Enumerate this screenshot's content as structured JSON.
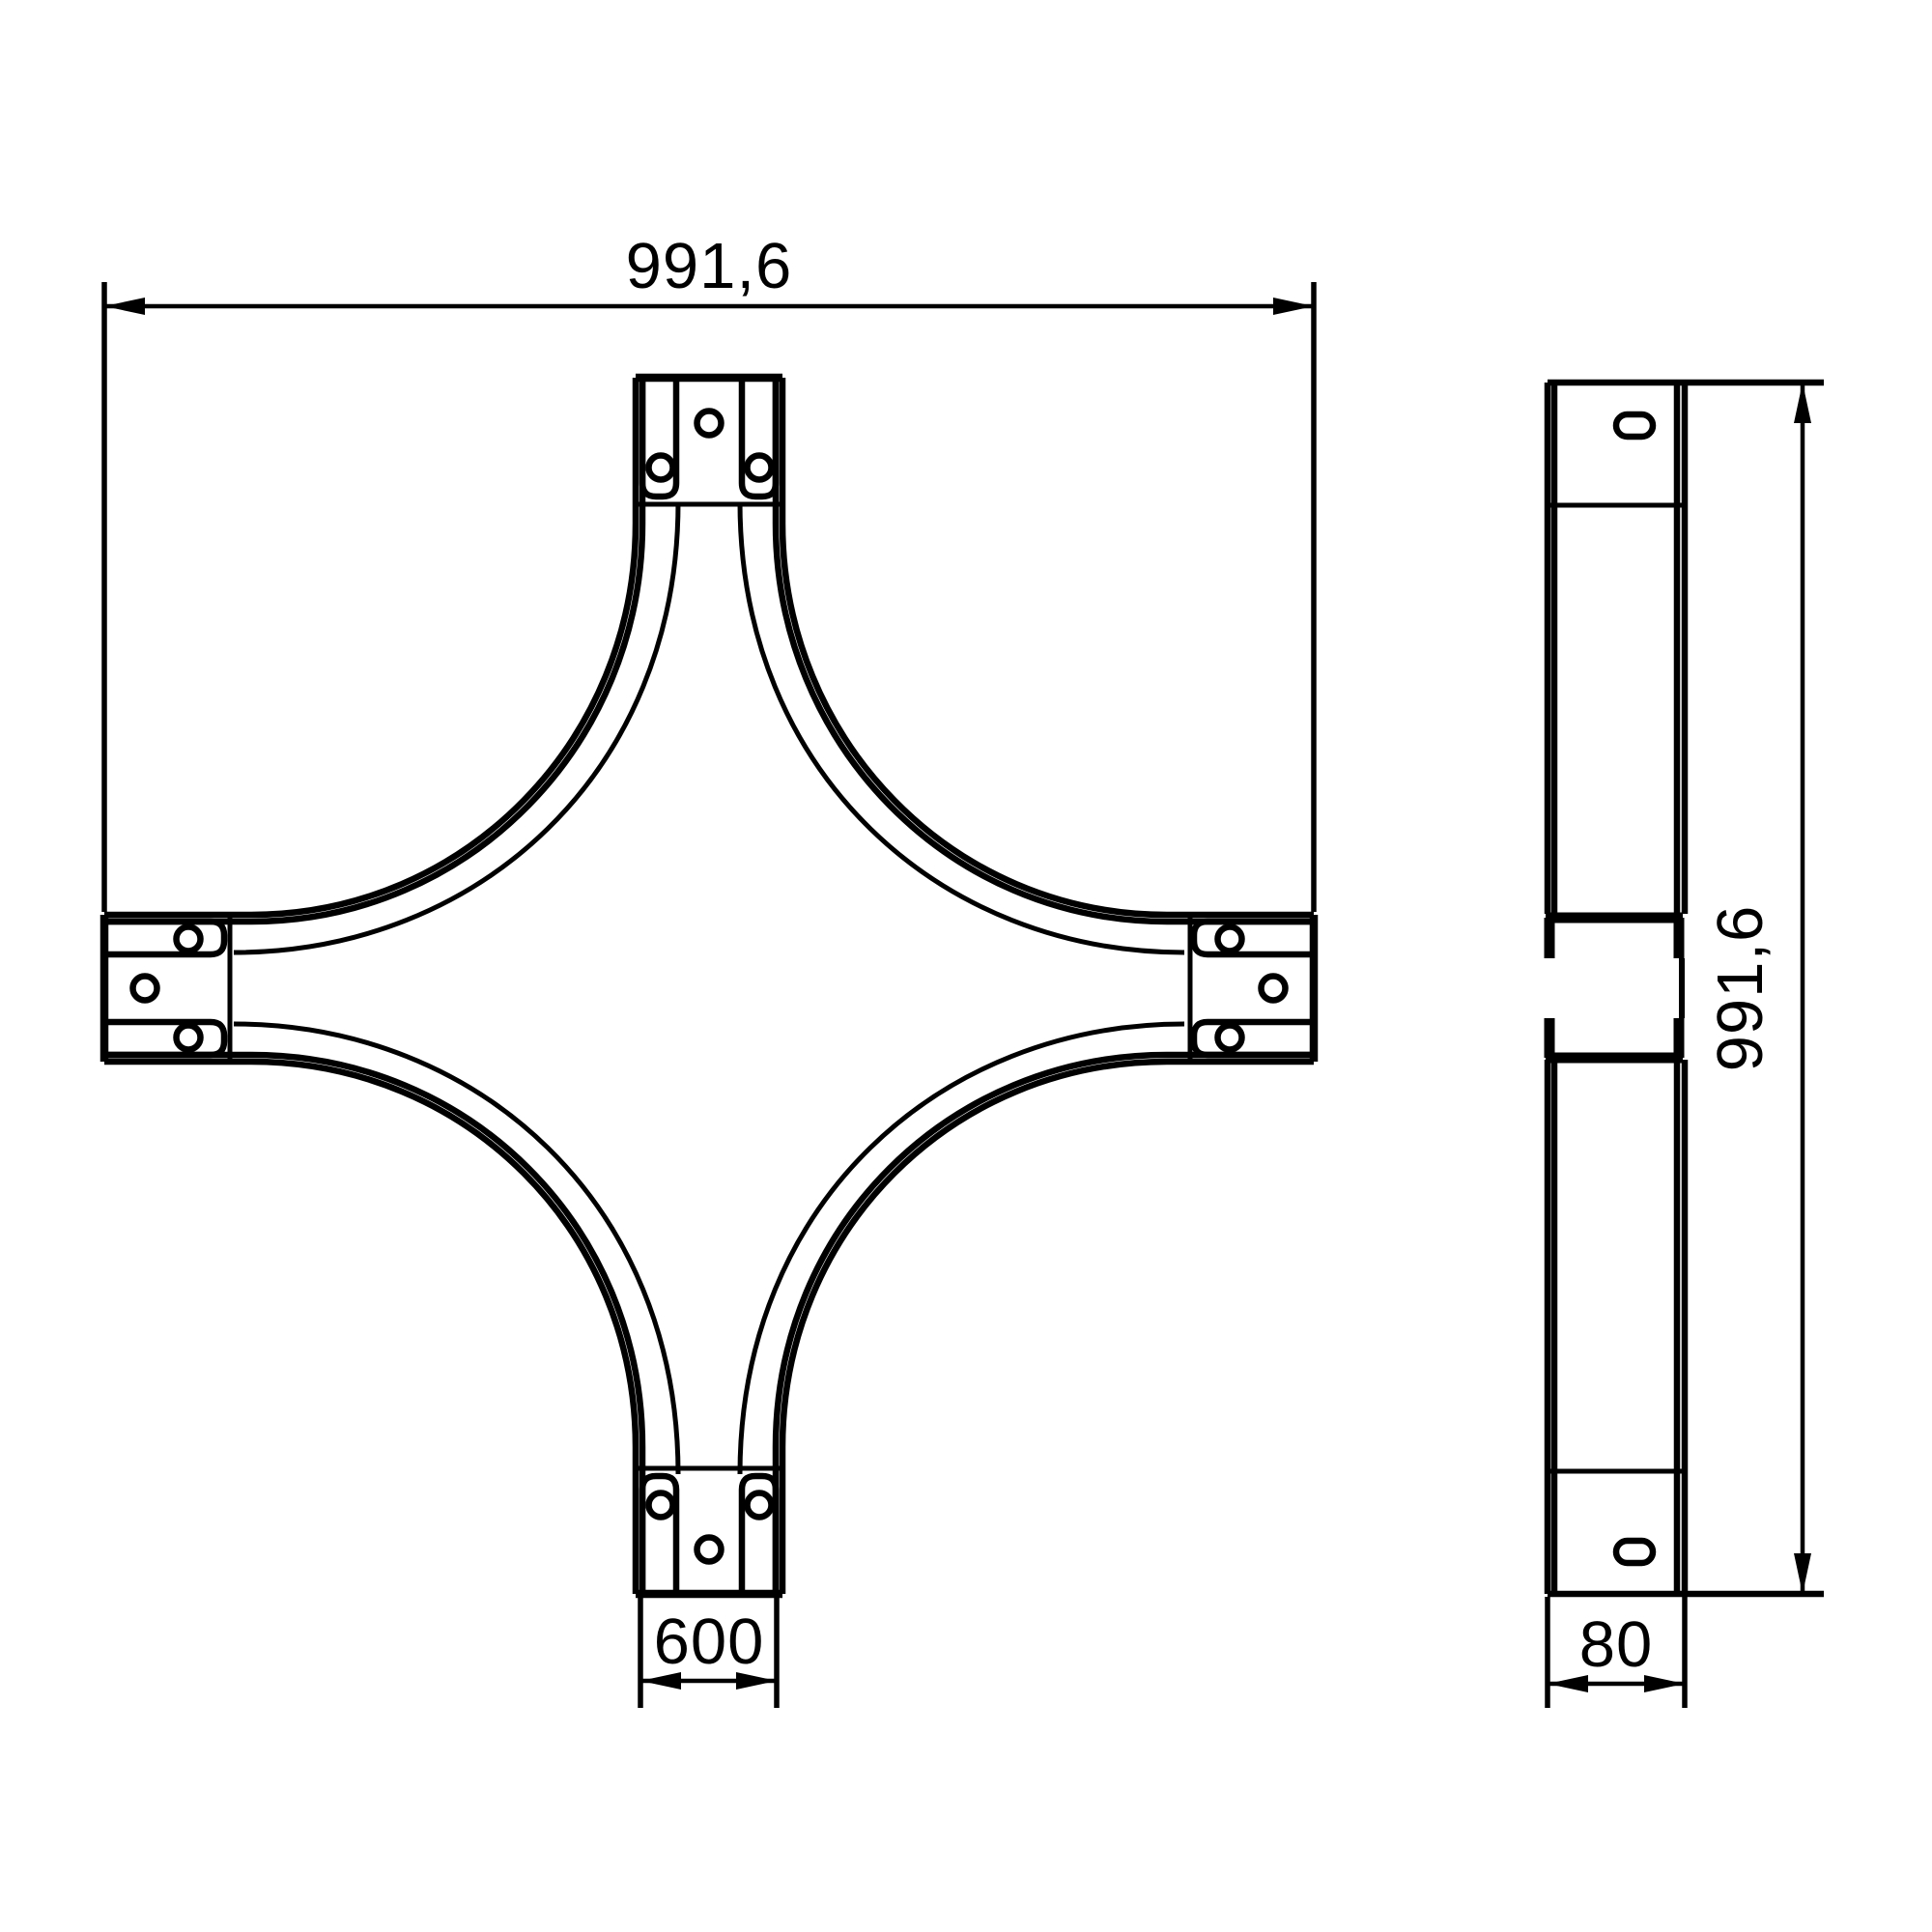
{
  "drawing": {
    "description": "Technical dimensional drawing of a cable tray crossover (X-piece), plan view and side elevation",
    "background_color": "#ffffff",
    "line_color": "#000000",
    "plan_view": {
      "name": "plan view of crossover piece",
      "features": {
        "branches": 4,
        "holes_per_branch_end": 3,
        "flange_tabs_per_branch": 2
      },
      "dim_overall_width": "991,6",
      "dim_tray_width": "600"
    },
    "side_view": {
      "name": "side elevation of crossover piece",
      "slot_holes": 2,
      "dim_overall_length": "991,6",
      "dim_profile_height": "80"
    }
  }
}
